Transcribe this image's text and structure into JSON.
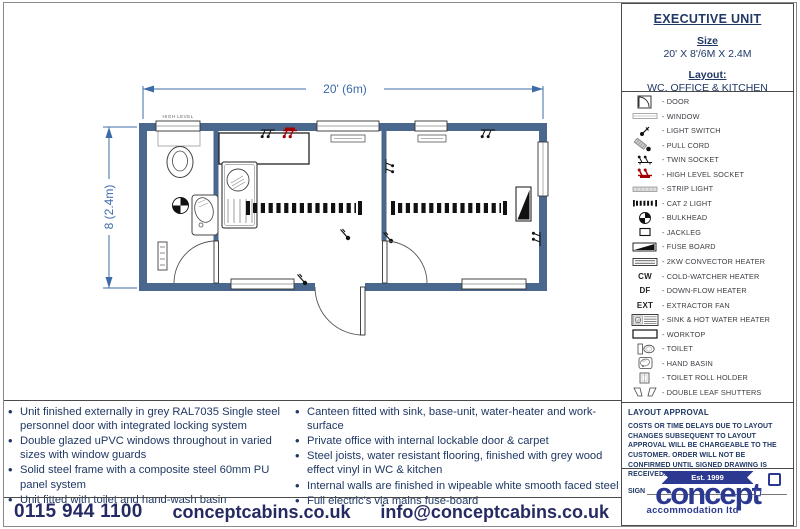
{
  "title_box": {
    "title": "EXECUTIVE UNIT",
    "size_label": "Size",
    "size_value": "20' X 8'/6M X 2.4M",
    "layout_label": "Layout:",
    "layout_value": "WC, OFFICE & KITCHEN"
  },
  "plan": {
    "width_dim": "20' (6m)",
    "height_dim": "8 (2.4m)",
    "high_level_label": "HIGH LEVEL"
  },
  "legend": {
    "separator": "-",
    "items": [
      {
        "icon": "door",
        "label": "DOOR"
      },
      {
        "icon": "window",
        "label": "WINDOW"
      },
      {
        "icon": "light-switch",
        "label": "LIGHT SWITCH"
      },
      {
        "icon": "pull-cord",
        "label": "PULL CORD"
      },
      {
        "icon": "twin-socket",
        "label": "TWIN SOCKET"
      },
      {
        "icon": "high-level-socket",
        "label": "HIGH LEVEL SOCKET"
      },
      {
        "icon": "strip-light",
        "label": "STRIP LIGHT"
      },
      {
        "icon": "cat2-light",
        "label": "CAT 2 LIGHT"
      },
      {
        "icon": "bulkhead",
        "label": "BULKHEAD"
      },
      {
        "icon": "jackleg",
        "label": "JACKLEG"
      },
      {
        "icon": "fuse-board",
        "label": "FUSE BOARD"
      },
      {
        "icon": "convector-heater",
        "label": "2KW CONVECTOR HEATER"
      },
      {
        "icon": "text",
        "symbol": "CW",
        "label": "COLD-WATCHER HEATER"
      },
      {
        "icon": "text",
        "symbol": "DF",
        "label": "DOWN-FLOW HEATER"
      },
      {
        "icon": "text",
        "symbol": "EXT",
        "label": "EXTRACTOR FAN"
      },
      {
        "icon": "sink-heater",
        "label": "SINK & HOT WATER HEATER"
      },
      {
        "icon": "worktop",
        "label": "WORKTOP"
      },
      {
        "icon": "toilet",
        "label": "TOILET"
      },
      {
        "icon": "hand-basin",
        "label": "HAND BASIN"
      },
      {
        "icon": "toilet-roll-holder",
        "label": "TOILET ROLL HOLDER"
      },
      {
        "icon": "double-leaf-shutters",
        "label": "DOUBLE LEAF SHUTTERS"
      }
    ]
  },
  "features": {
    "left": [
      "Unit finished externally in grey RAL7035 Single steel personnel door with integrated locking system",
      "Double glazed uPVC windows throughout in varied sizes with window guards",
      "Solid steel frame with a composite steel 60mm PU panel system",
      "Unit fitted with toilet and hand-wash basin"
    ],
    "right": [
      "Canteen fitted with sink, base-unit, water-heater and work-surface",
      "Private office with internal lockable door & carpet",
      "Steel joists, water resistant flooring, finished with grey wood effect vinyl in WC & kitchen",
      "Internal walls are finished in wipeable white smooth faced steel",
      "Full electric's via mains fuse-board"
    ]
  },
  "approval": {
    "heading": "LAYOUT APPROVAL",
    "body": "COSTS OR TIME DELAYS DUE TO LAYOUT CHANGES SUBSEQUENT TO LAYOUT APPROVAL WILL BE CHARGEABLE TO THE CUSTOMER. ORDER WILL NOT BE CONFIRMED UNTIL SIGNED DRAWING IS RECEIVED.",
    "sign_label": "SIGN"
  },
  "logo": {
    "est": "Est. 1999",
    "name": "concept",
    "subtitle": "accommodation ltd"
  },
  "contact": {
    "phone": "0115 944 1100",
    "website": "conceptcabins.co.uk",
    "email": "info@conceptcabins.co.uk"
  },
  "colors": {
    "wall": "#4a688e",
    "dimension": "#3c6ca8",
    "navy_text": "#1f3864",
    "socket_red": "#a00000",
    "logo_navy": "#2b3990"
  }
}
